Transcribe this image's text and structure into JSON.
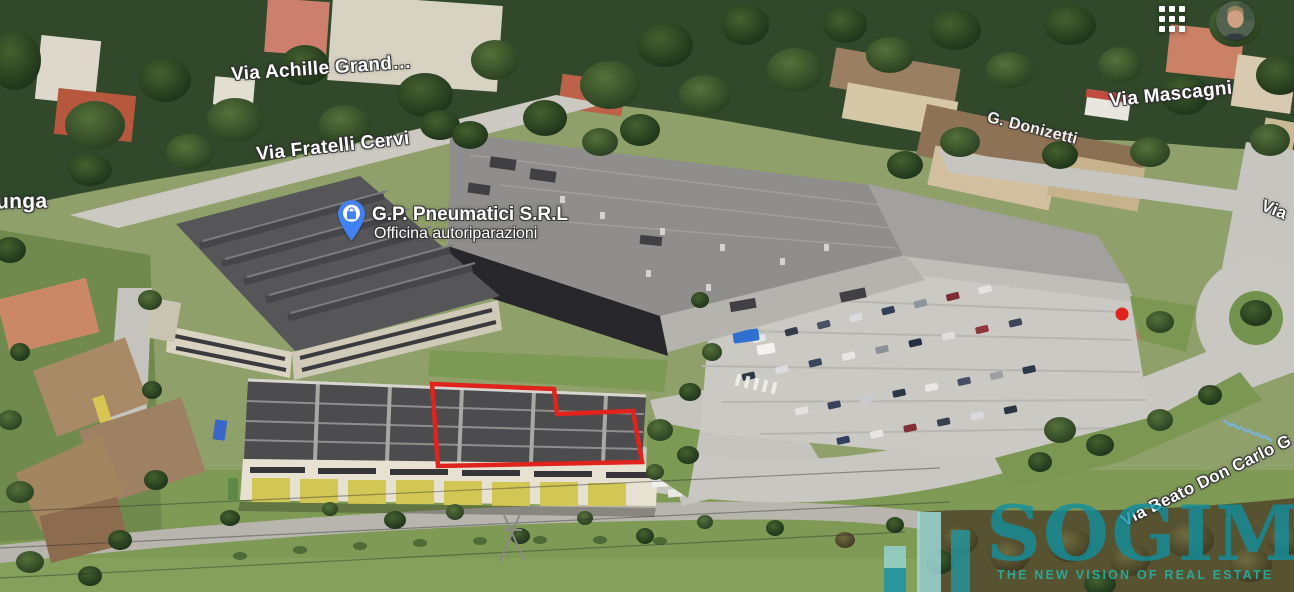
{
  "view": {
    "type": "3d-aerial-satellite-map"
  },
  "toolbar": {
    "apps_menu_icon": "google-apps-grid-icon",
    "avatar_icon": "user-profile-avatar"
  },
  "map": {
    "poi_marker": {
      "title": "G.P. Pneumatici S.R.L",
      "subtitle": "Officina autoriparazioni",
      "icon": "shopping-bag-pin-icon",
      "pin_color": "#4082f2"
    },
    "street_labels": [
      {
        "text": "unga"
      },
      {
        "text": "Via Achille Grand…"
      },
      {
        "text": "Via Fratelli Cervi"
      },
      {
        "text": "Via Mascagni"
      },
      {
        "text": "G. Donizetti"
      },
      {
        "text": "Via Beato Don Carlo G"
      },
      {
        "text": "Via"
      }
    ],
    "highlight_polygon": {
      "description": "red outline around right section of warehouse roof",
      "color": "#e0231c"
    },
    "spot_marker": {
      "description": "small red dot on path near roundabout",
      "color": "#e0231c"
    }
  },
  "watermark": {
    "brand": "SOGIM",
    "tagline": "THE NEW VISION OF REAL ESTATE",
    "color": "#108e9e"
  }
}
